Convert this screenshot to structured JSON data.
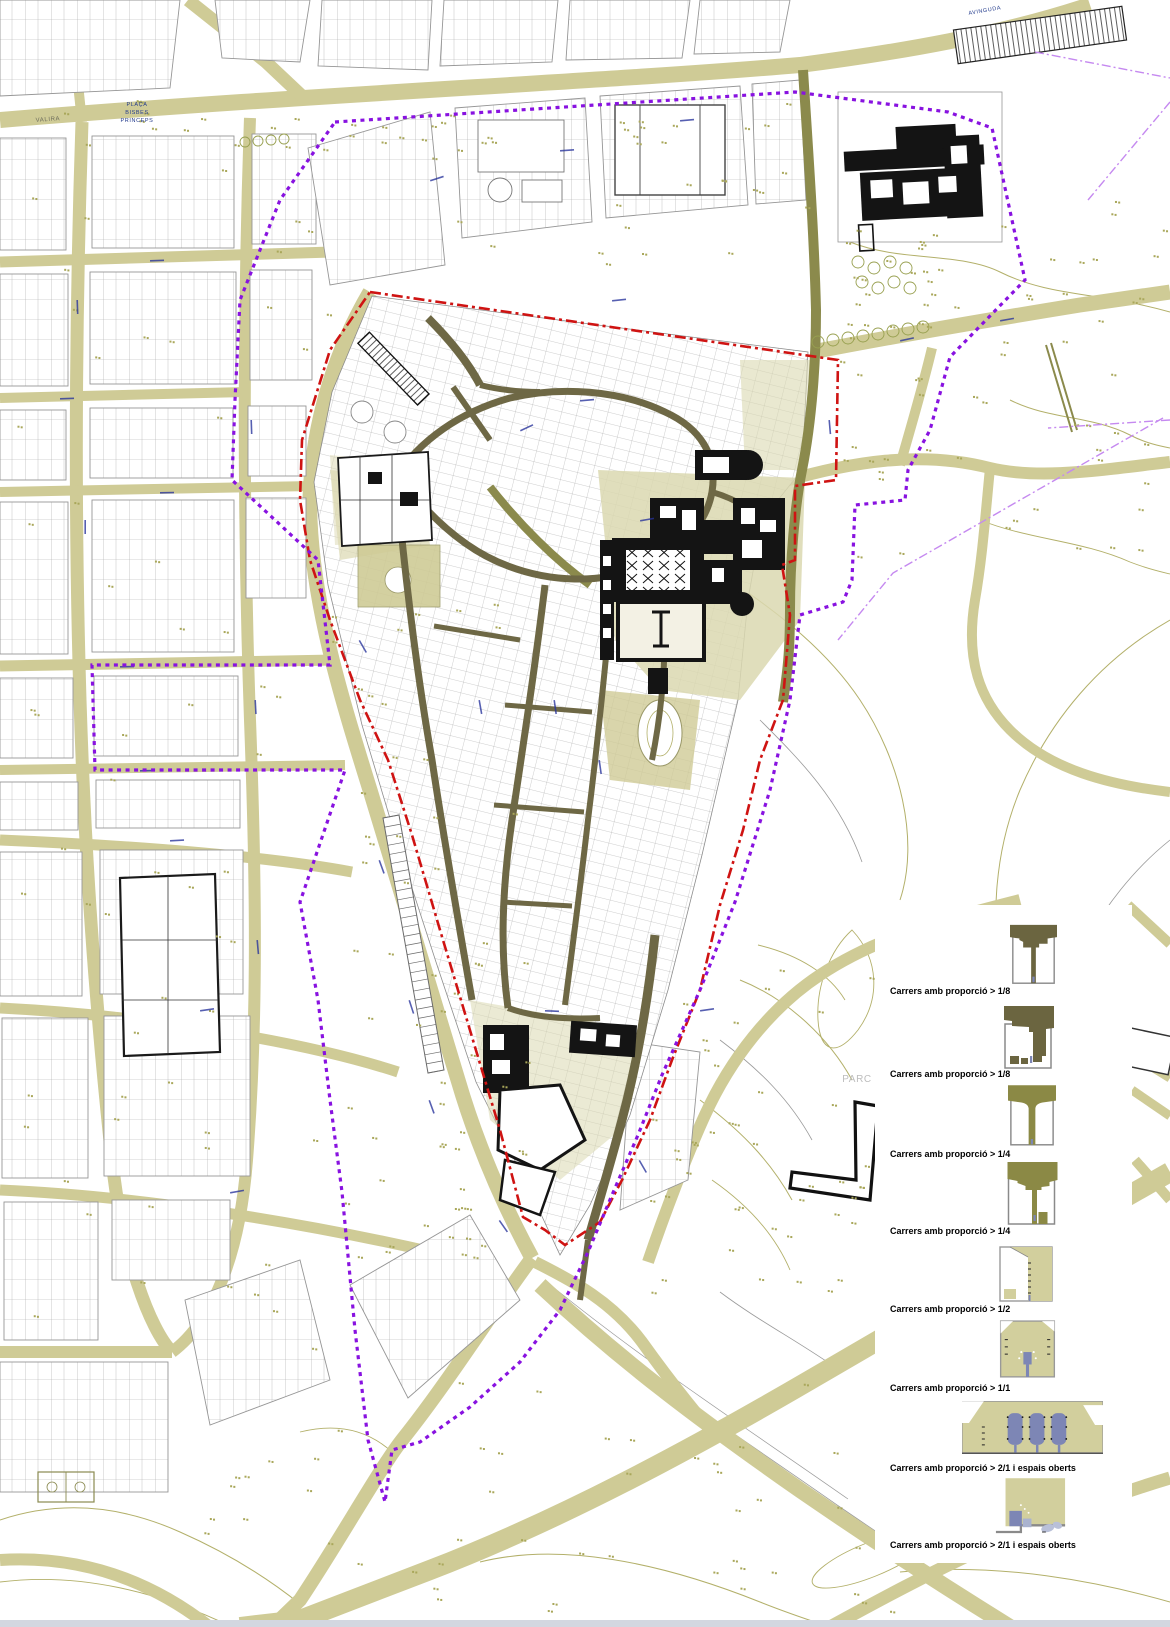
{
  "colors": {
    "road_khaki": "#cfcb96",
    "road_light": "#d9d6ab",
    "street_dark_olive": "#6e6845",
    "street_medium_olive": "#8b8a4c",
    "old_town_tint": "#dbd8b0",
    "contour_olive": "#b3b06a",
    "contour_gray": "#9a9a9a",
    "parcel_line": "#969696",
    "building_black": "#141414",
    "boundary_red": "#cf1312",
    "boundary_purple": "#8812e0",
    "guide_violet": "#c589f0",
    "street_label_blue": "#27329b",
    "tree_dot_olive": "#a9a75a",
    "legend_dark": "#6b6540",
    "legend_medium": "#8b8945",
    "legend_light": "#d2cf9d",
    "legend_figure_blue": "#7d86b5",
    "footer_bar": "#d3d7e0"
  },
  "legend": {
    "items": [
      {
        "label": "Carrers amb proporció > 1/8",
        "icon": "sec-dark-a"
      },
      {
        "label": "Carrers amb proporció > 1/8",
        "icon": "sec-dark-b"
      },
      {
        "label": "Carrers amb proporció > 1/4",
        "icon": "sec-med-a"
      },
      {
        "label": "Carrers amb proporció > 1/4",
        "icon": "sec-med-b"
      },
      {
        "label": "Carrers amb proporció > 1/2",
        "icon": "sec-light-a"
      },
      {
        "label": "Carrers amb proporció > 1/1",
        "icon": "sec-light-b"
      },
      {
        "label": "Carrers amb proporció > 2/1 i espais oberts",
        "icon": "sec-wide"
      },
      {
        "label": "Carrers amb proporció > 2/1 i espais oberts",
        "icon": "sec-open"
      }
    ]
  },
  "map": {
    "labels": [
      {
        "lines": [
          "PLAÇA",
          "BISBES",
          "PRINCEPS"
        ],
        "x": 137,
        "y": 106,
        "size": 5.5,
        "color": "#223a8c",
        "rotate": 0,
        "lh": 8,
        "anchor": "middle"
      },
      {
        "lines": [
          "VALIRA"
        ],
        "x": 48,
        "y": 121,
        "size": 6,
        "color": "#6b6b5a",
        "rotate": -4,
        "lh": 7,
        "anchor": "middle"
      },
      {
        "lines": [
          "AVINGUDA"
        ],
        "x": 985,
        "y": 12,
        "size": 5.5,
        "color": "#223a8c",
        "rotate": -10,
        "lh": 7,
        "anchor": "middle"
      },
      {
        "lines": [
          "PARC"
        ],
        "x": 857,
        "y": 1082,
        "size": 10,
        "color": "#bdbdbd",
        "rotate": 0,
        "lh": 10,
        "anchor": "middle"
      }
    ]
  }
}
